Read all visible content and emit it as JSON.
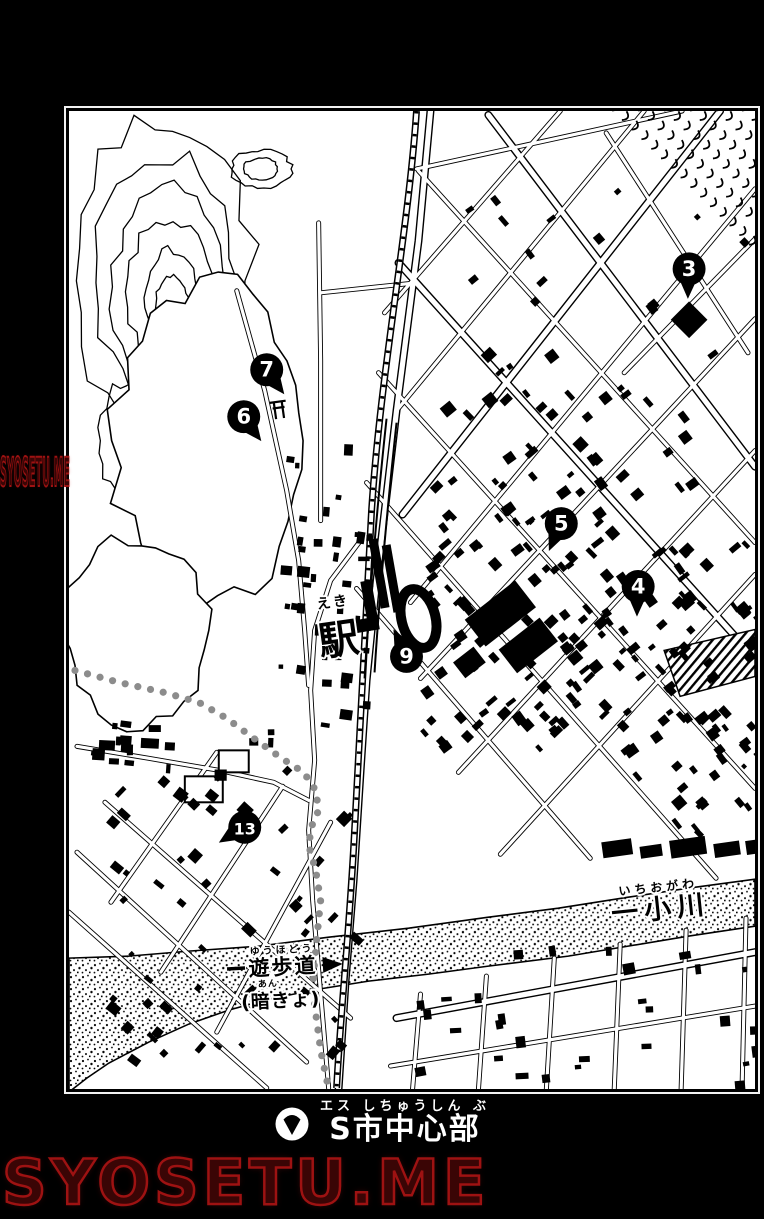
{
  "page": {
    "background": "#000000",
    "panel_background": "#ffffff"
  },
  "watermark": {
    "text": "SYOSETU.ME",
    "color_fill": "#3a0505",
    "color_stroke": "#9e1212"
  },
  "caption": {
    "icon": "map-pin-down-icon",
    "furigana": "エス しちゅうしん ぶ",
    "text": "S市中心部"
  },
  "map": {
    "station": {
      "furigana": "えき",
      "label": "駅"
    },
    "river": {
      "furigana": "いちおがわ",
      "label": "一小川"
    },
    "promenade": {
      "furigana": "ゆうほどう",
      "label": "遊歩道"
    },
    "culvert": {
      "furigana": "あん",
      "label": "(暗きょ)"
    },
    "trail_color": "#8c8c8c",
    "ink_color": "#000000",
    "markers": [
      {
        "number": "3",
        "x": 621,
        "y": 158,
        "dir": "down"
      },
      {
        "number": "7",
        "x": 198,
        "y": 259,
        "dir": "down-right"
      },
      {
        "number": "6",
        "x": 175,
        "y": 306,
        "dir": "down-right"
      },
      {
        "number": "5",
        "x": 493,
        "y": 413,
        "dir": "down-left"
      },
      {
        "number": "4",
        "x": 570,
        "y": 476,
        "dir": "down"
      },
      {
        "number": "9",
        "x": 338,
        "y": 546,
        "dir": "up"
      },
      {
        "number": "13",
        "x": 176,
        "y": 717,
        "dir": "left"
      }
    ]
  }
}
